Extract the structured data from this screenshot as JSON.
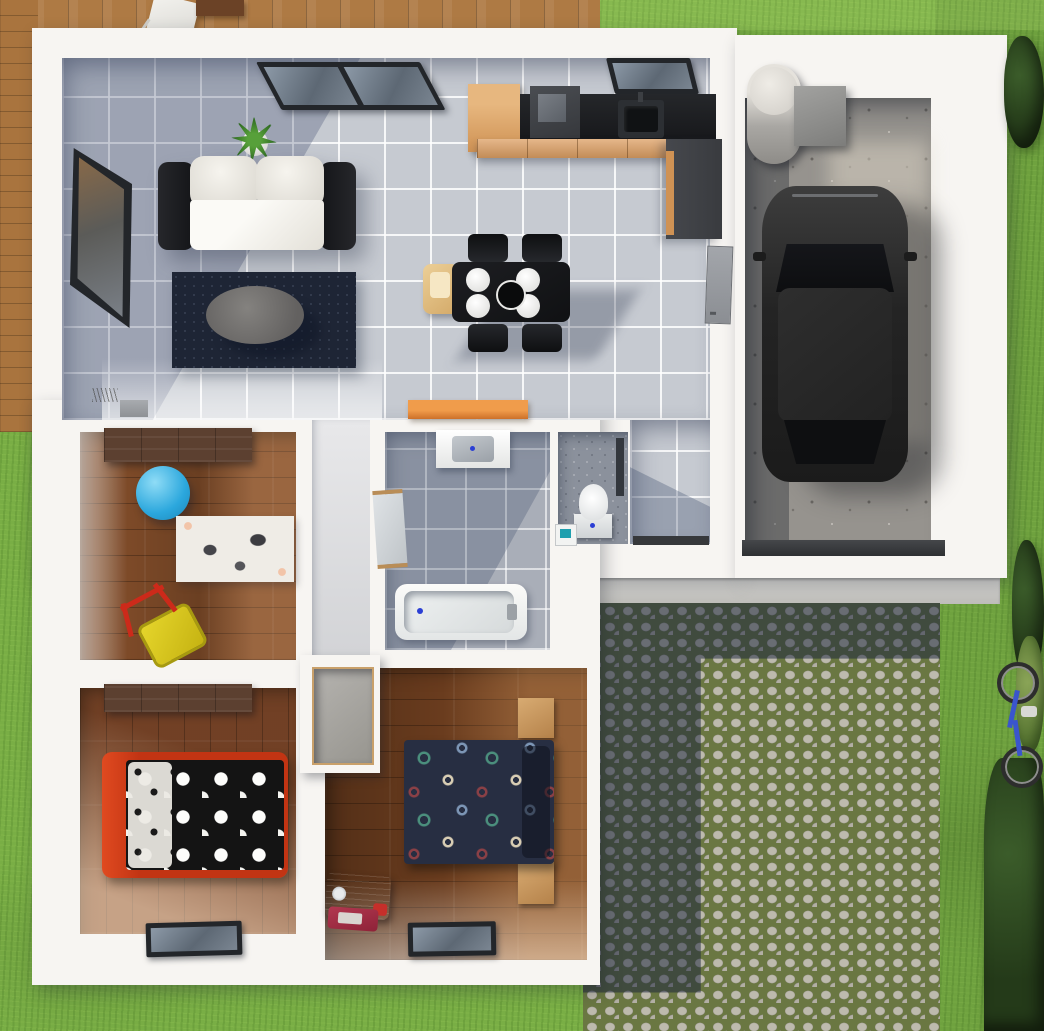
{
  "scene": {
    "kind": "3d-floor-plan-top-view",
    "description": "Photorealistic top-down 3D rendering of a single-storey house with attached garage, wooden terrace, cobblestone driveway and lawn garden",
    "text_on_screen": "none"
  },
  "palette": {
    "grass": "#79ae45",
    "deck_wood": "#ae7a44",
    "wall_white": "#f7f5f2",
    "tile_floor": "#c6cad1",
    "bathroom_tile": "#a9aeb8",
    "bedroom_wood": "#7d4a28",
    "wardrobe_wood": "#5c4030",
    "concrete": "#96938e",
    "cobble_stone": "#b5b2a6",
    "cobble_moss": "#6a7742",
    "counter_black": "#202225",
    "cabinet_orange": "#dd9f63",
    "doormat_orange": "#e88a3c",
    "rug_navy": "#1e2535",
    "gym_ball_blue": "#2ba7dd",
    "bed_frame_red": "#cf3b16",
    "suitcase_magenta": "#8f2c4e",
    "bike_blue": "#3a55cc",
    "car_body": "#262626"
  },
  "outdoor": {
    "areas": [
      "wooden-terrace-top-left",
      "lawn",
      "cobblestone-driveway-bottom-right",
      "concrete-entrance-step"
    ],
    "objects": [
      "white-folding-chair",
      "terrace-table",
      "blue-bicycle",
      "hedge-bushes",
      "parked-black-car"
    ]
  },
  "rooms": [
    {
      "name": "living-room",
      "floor": "grey-tiles",
      "objects": [
        "black-and-white-sofa",
        "navy-area-rug",
        "oval-coffee-table",
        "potted-plant",
        "side-window",
        "top-window"
      ]
    },
    {
      "name": "kitchen-dining",
      "floor": "grey-tiles",
      "objects": [
        "orange-tall-cabinet",
        "black-countertop",
        "cooktop",
        "kitchen-sink",
        "kitchen-window",
        "orange-base-cabinets",
        "dark-side-counter",
        "dining-table",
        "four-black-chairs",
        "four-white-plates",
        "serving-bowl",
        "wooden-high-chair"
      ]
    },
    {
      "name": "hallway",
      "floor": "grey-tiles",
      "objects": [
        "orange-doormat",
        "entrance-door-sill",
        "garage-connecting-door",
        "radiator"
      ]
    },
    {
      "name": "kids-playroom",
      "floor": "wood",
      "objects": [
        "dark-wardrobe",
        "blue-gym-ball",
        "zebra-print-rug",
        "yellow-toy-wheelbarrow",
        "side-window"
      ]
    },
    {
      "name": "bathroom",
      "floor": "grey-tiles",
      "objects": [
        "washbasin-vanity",
        "bathtub",
        "mirror-door"
      ]
    },
    {
      "name": "wc",
      "floor": "speckled-tiles",
      "objects": [
        "toilet",
        "small-hand-basin"
      ]
    },
    {
      "name": "child-bedroom",
      "floor": "wood",
      "objects": [
        "dark-wardrobe",
        "red-bed-black-white-polka-duvet",
        "facade-window"
      ]
    },
    {
      "name": "master-bedroom",
      "floor": "wood",
      "objects": [
        "double-bed-navy-patterned-duvet",
        "two-wooden-nightstands",
        "open-closet",
        "magenta-suitcase",
        "luggage-scale",
        "facade-window"
      ]
    },
    {
      "name": "garage",
      "floor": "concrete",
      "objects": [
        "black-car",
        "water-heater-cylinder",
        "boiler-box",
        "garage-door-sill"
      ]
    }
  ]
}
